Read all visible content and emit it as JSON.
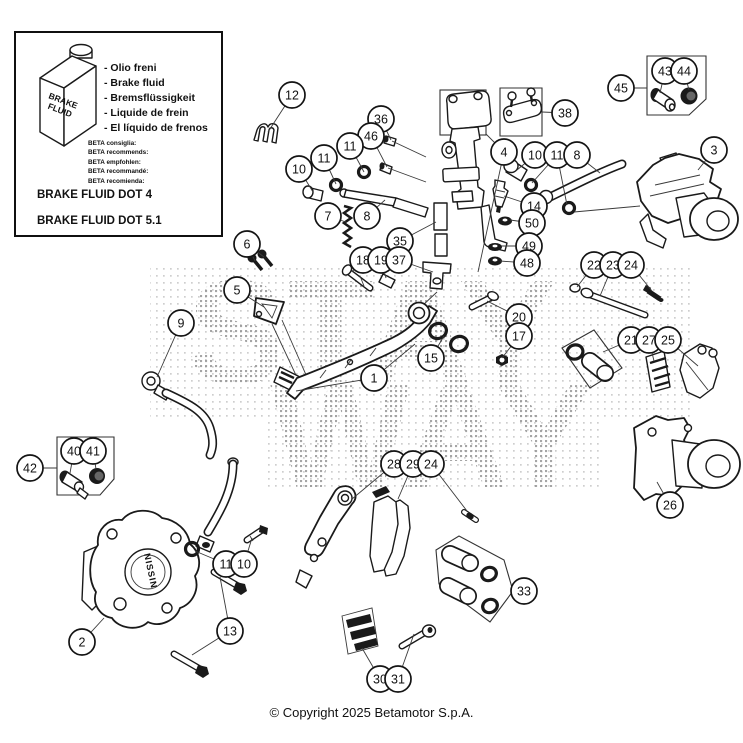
{
  "watermark": {
    "line1": "STAY",
    "line2": "WAY"
  },
  "copyright": "© Copyright 2025 Betamotor S.p.A.",
  "labels": {
    "caliper_brand": "NISSIN",
    "bottle_line1": "BRAKE",
    "bottle_line2": "FLUID"
  },
  "info_box": {
    "fluid_names": [
      "- Olio freni",
      "- Brake fluid",
      "- Bremsflüssigkeit",
      "- Liquide de frein",
      "- El líquido de frenos"
    ],
    "beta_lines": [
      "BETA consiglia:",
      "BETA recommends:",
      "BETA empfohlen:",
      "BETA recommandé:",
      "BETA recomienda:"
    ],
    "dot4": "BRAKE FLUID DOT 4",
    "dot51": "BRAKE FLUID DOT 5.1"
  },
  "colors": {
    "line": "#1a1a1a",
    "leader": "#3a3a3a",
    "watermark_dots": "#a6a6a6"
  },
  "callouts": [
    {
      "n": "12",
      "x": 292,
      "y": 95,
      "tx": 268,
      "ty": 132
    },
    {
      "n": "36",
      "x": 381,
      "y": 119,
      "tx": 391,
      "ty": 140
    },
    {
      "n": "46",
      "x": 371,
      "y": 136,
      "tx": 387,
      "ty": 167
    },
    {
      "n": "11",
      "x": 350,
      "y": 146,
      "tx": 364,
      "ty": 172
    },
    {
      "n": "11",
      "x": 324,
      "y": 158,
      "tx": 336,
      "ty": 184
    },
    {
      "n": "10",
      "x": 299,
      "y": 169,
      "tx": 313,
      "ty": 192
    },
    {
      "n": "7",
      "x": 328,
      "y": 216,
      "tx": 346,
      "ty": 222
    },
    {
      "n": "8",
      "x": 367,
      "y": 216,
      "tx": 385,
      "ty": 200
    },
    {
      "n": "35",
      "x": 400,
      "y": 241,
      "tx": 436,
      "ty": 222
    },
    {
      "n": "18",
      "x": 363,
      "y": 260,
      "tx": 352,
      "ty": 272
    },
    {
      "n": "19",
      "x": 381,
      "y": 260,
      "tx": 386,
      "ty": 278
    },
    {
      "n": "37",
      "x": 399,
      "y": 260,
      "tx": 433,
      "ty": 272
    },
    {
      "n": "38",
      "x": 565,
      "y": 113,
      "tx": 542,
      "ty": 112
    },
    {
      "n": "4",
      "x": 504,
      "y": 152,
      "tx": 486,
      "ty": 134,
      "t2x": 478,
      "t2y": 272
    },
    {
      "n": "10",
      "x": 535,
      "y": 155,
      "tx": 517,
      "ty": 170
    },
    {
      "n": "11",
      "x": 557,
      "y": 155,
      "tx": 532,
      "ty": 183,
      "t2x": 567,
      "t2y": 205
    },
    {
      "n": "8",
      "x": 577,
      "y": 155,
      "tx": 600,
      "ty": 173
    },
    {
      "n": "3",
      "x": 714,
      "y": 150,
      "tx": 698,
      "ty": 170
    },
    {
      "n": "45",
      "x": 621,
      "y": 88,
      "tx": 647,
      "ty": 88
    },
    {
      "n": "43",
      "x": 665,
      "y": 71,
      "tx": 660,
      "ty": 93
    },
    {
      "n": "44",
      "x": 684,
      "y": 71,
      "tx": 689,
      "ty": 90
    },
    {
      "n": "14",
      "x": 534,
      "y": 206,
      "tx": 504,
      "ty": 196
    },
    {
      "n": "50",
      "x": 532,
      "y": 223,
      "tx": 510,
      "ty": 220
    },
    {
      "n": "49",
      "x": 529,
      "y": 246,
      "tx": 501,
      "ty": 246
    },
    {
      "n": "48",
      "x": 527,
      "y": 263,
      "tx": 500,
      "ty": 261
    },
    {
      "n": "22",
      "x": 594,
      "y": 265,
      "tx": 577,
      "ty": 287
    },
    {
      "n": "23",
      "x": 613,
      "y": 265,
      "tx": 600,
      "ty": 296
    },
    {
      "n": "24",
      "x": 631,
      "y": 265,
      "tx": 652,
      "ty": 291
    },
    {
      "n": "6",
      "x": 247,
      "y": 244,
      "tx": 255,
      "ty": 261,
      "t2x": 264,
      "t2y": 257
    },
    {
      "n": "5",
      "x": 237,
      "y": 290,
      "tx": 264,
      "ty": 307
    },
    {
      "n": "9",
      "x": 181,
      "y": 323,
      "tx": 157,
      "ty": 377
    },
    {
      "n": "1",
      "x": 374,
      "y": 378,
      "tx": 296,
      "ty": 391,
      "t2x": 415,
      "t2y": 344
    },
    {
      "n": "20",
      "x": 519,
      "y": 317,
      "tx": 487,
      "ty": 301
    },
    {
      "n": "17",
      "x": 519,
      "y": 336,
      "tx": 502,
      "ty": 358
    },
    {
      "n": "15",
      "x": 431,
      "y": 358,
      "tx": 444,
      "ty": 336
    },
    {
      "n": "21",
      "x": 631,
      "y": 340,
      "tx": 603,
      "ty": 352
    },
    {
      "n": "27",
      "x": 649,
      "y": 340,
      "tx": 654,
      "ty": 361
    },
    {
      "n": "25",
      "x": 668,
      "y": 340,
      "tx": 698,
      "ty": 366
    },
    {
      "n": "26",
      "x": 670,
      "y": 505,
      "tx": 657,
      "ty": 482
    },
    {
      "n": "42",
      "x": 30,
      "y": 468,
      "tx": 57,
      "ty": 468
    },
    {
      "n": "40",
      "x": 74,
      "y": 451,
      "tx": 70,
      "ty": 473
    },
    {
      "n": "41",
      "x": 93,
      "y": 451,
      "tx": 96,
      "ty": 469
    },
    {
      "n": "28",
      "x": 394,
      "y": 464,
      "tx": 352,
      "ty": 499
    },
    {
      "n": "29",
      "x": 413,
      "y": 464,
      "tx": 398,
      "ty": 499
    },
    {
      "n": "24",
      "x": 431,
      "y": 464,
      "tx": 467,
      "ty": 511
    },
    {
      "n": "33",
      "x": 524,
      "y": 591,
      "tx": 512,
      "ty": 591
    },
    {
      "n": "2",
      "x": 82,
      "y": 642,
      "tx": 104,
      "ty": 618
    },
    {
      "n": "11",
      "x": 226,
      "y": 564,
      "tx": 195,
      "ty": 551
    },
    {
      "n": "10",
      "x": 244,
      "y": 564,
      "tx": 252,
      "ty": 538
    },
    {
      "n": "13",
      "x": 230,
      "y": 631,
      "tx": 220,
      "ty": 577,
      "t2x": 192,
      "t2y": 655
    },
    {
      "n": "30",
      "x": 380,
      "y": 679,
      "tx": 362,
      "ty": 648
    },
    {
      "n": "31",
      "x": 398,
      "y": 679,
      "tx": 414,
      "ty": 634
    }
  ]
}
